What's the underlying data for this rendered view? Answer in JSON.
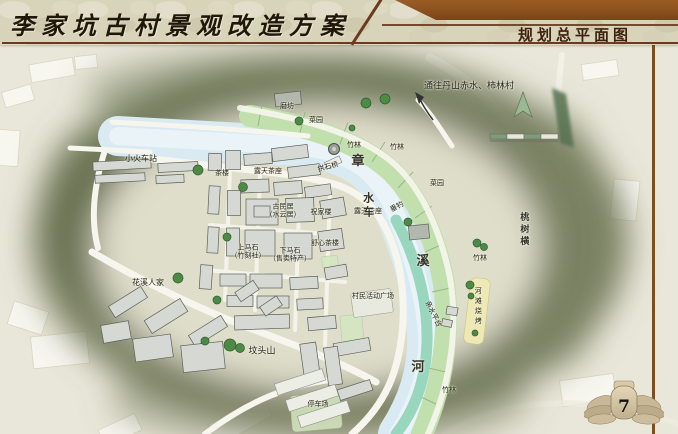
{
  "header": {
    "title": "李家坑古村景观改造方案",
    "subtitle": "规划总平面图"
  },
  "page": {
    "number": "7"
  },
  "colors": {
    "stone": "#d8d4ba",
    "banner": "#8a4f1d",
    "rule": "#6b3a1f",
    "title_ink": "#211708",
    "subtitle_ink": "#3d220d",
    "map_bg": "#e9e7d9",
    "blob": "#6f7555",
    "river": "#d9eaf3",
    "river_core": "#ecf5f9",
    "field": "#c2dfae",
    "field_line": "#96b886",
    "water_teal": "#93d4ba",
    "sand": "#eee9b4",
    "road": "#f7f6ee",
    "building": "#d6d9d3",
    "building_edge": "#5d6159",
    "tree": "#4e8a46",
    "tree_dark": "#2f5c2b",
    "ink": "#262619"
  },
  "map": {
    "labels": [
      {
        "t": "通往丹山赤水、柿林村",
        "x": 469,
        "y": 87,
        "s": 9
      },
      {
        "t": "小火车站",
        "x": 141,
        "y": 159,
        "s": 8
      },
      {
        "t": "磨坊",
        "x": 287,
        "y": 106,
        "s": 7
      },
      {
        "t": "菜园",
        "x": 316,
        "y": 120,
        "s": 7
      },
      {
        "t": "竹林",
        "x": 354,
        "y": 145,
        "s": 7
      },
      {
        "t": "竹林",
        "x": 397,
        "y": 147,
        "s": 7
      },
      {
        "t": "菜园",
        "x": 437,
        "y": 183,
        "s": 7
      },
      {
        "t": "竹林",
        "x": 480,
        "y": 258,
        "s": 7
      },
      {
        "t": "竹林",
        "x": 449,
        "y": 390,
        "s": 7
      },
      {
        "t": "茶楼",
        "x": 222,
        "y": 173,
        "s": 7
      },
      {
        "t": "露天茶座",
        "x": 268,
        "y": 171,
        "s": 7
      },
      {
        "t": "拱石桥",
        "x": 328,
        "y": 167,
        "s": 7,
        "r": -15
      },
      {
        "t": "古民居\n（水云居）",
        "x": 283,
        "y": 211,
        "s": 7
      },
      {
        "t": "祝家楼",
        "x": 321,
        "y": 212,
        "s": 7
      },
      {
        "t": "舒心茶楼",
        "x": 325,
        "y": 243,
        "s": 7
      },
      {
        "t": "上马石\n（竹刻社）",
        "x": 248,
        "y": 252,
        "s": 7
      },
      {
        "t": "下马石\n（售卖特产）",
        "x": 290,
        "y": 255,
        "s": 7
      },
      {
        "t": "露天茶座",
        "x": 368,
        "y": 211,
        "s": 7
      },
      {
        "t": "垂钓",
        "x": 397,
        "y": 207,
        "s": 7,
        "r": -28
      },
      {
        "t": "花溪人家",
        "x": 148,
        "y": 283,
        "s": 8
      },
      {
        "t": "坟头山",
        "x": 262,
        "y": 352,
        "s": 9
      },
      {
        "t": "村民活动广场",
        "x": 373,
        "y": 296,
        "s": 7
      },
      {
        "t": "亲水平台",
        "x": 433,
        "y": 314,
        "s": 7,
        "r": 64
      },
      {
        "t": "河滩烧烤",
        "x": 478,
        "y": 307,
        "s": 7,
        "v": 1
      },
      {
        "t": "停车场",
        "x": 318,
        "y": 404,
        "s": 7
      },
      {
        "t": "桃树横",
        "x": 523,
        "y": 230,
        "s": 9,
        "v": 1,
        "f": 1
      },
      {
        "t": "章",
        "x": 358,
        "y": 162,
        "s": 13,
        "f": 1
      },
      {
        "t": "水车",
        "x": 368,
        "y": 206,
        "s": 11,
        "v": 1,
        "f": 1
      },
      {
        "t": "溪",
        "x": 423,
        "y": 262,
        "s": 13,
        "f": 1
      },
      {
        "t": "河",
        "x": 418,
        "y": 368,
        "s": 13,
        "f": 1
      }
    ]
  }
}
